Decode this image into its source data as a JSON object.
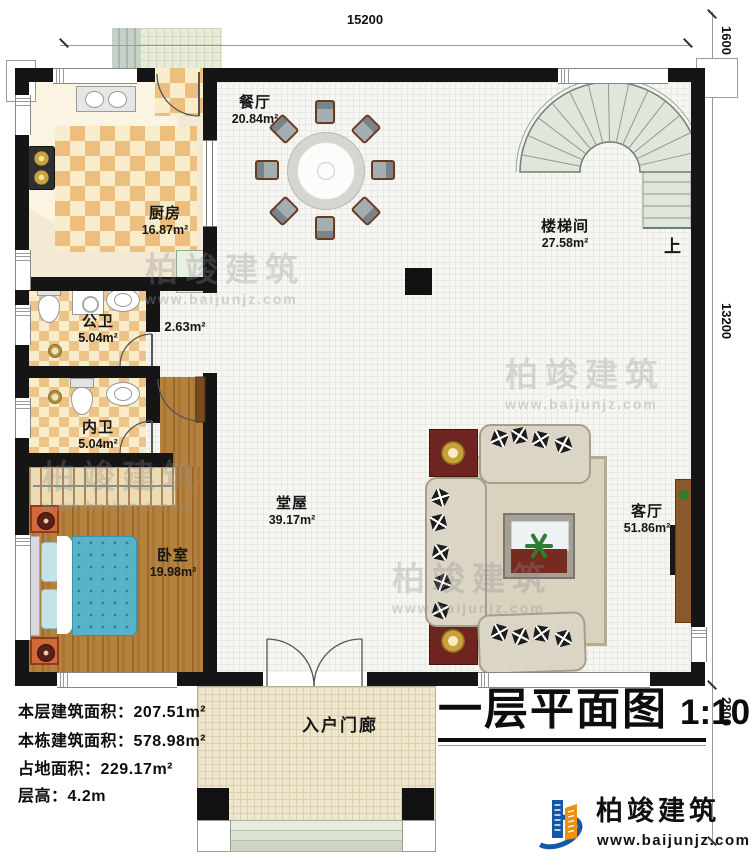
{
  "title_block": {
    "title": "一层平面图",
    "scale": "1:100"
  },
  "info": {
    "line1": "本层建筑面积：207.51m²",
    "line2": "本栋建筑面积：578.98m²",
    "line3": "占地面积：229.17m²",
    "line4": "层高：4.2m"
  },
  "rooms": {
    "dining": {
      "name": "餐厅",
      "area": "20.84m²"
    },
    "kitchen": {
      "name": "厨房",
      "area": "16.87m²"
    },
    "stairwell": {
      "name": "楼梯间",
      "area": "27.58m²"
    },
    "public_bath": {
      "name": "公卫",
      "area": "5.04m²"
    },
    "corridor": {
      "area": "2.63m²"
    },
    "private_bath": {
      "name": "内卫",
      "area": "5.04m²"
    },
    "bedroom": {
      "name": "卧室",
      "area": "19.98m²"
    },
    "hall": {
      "name": "堂屋",
      "area": "39.17m²"
    },
    "living": {
      "name": "客厅",
      "area": "51.86m²"
    },
    "porch": {
      "name": "入户门廊"
    }
  },
  "stairs": {
    "up_label": "上"
  },
  "dimensions": {
    "top": "15200",
    "right_top": "1600",
    "right_mid": "13200",
    "right_bottom": "2800"
  },
  "brand": {
    "name": "柏竣建筑",
    "url": "www.baijunjz.com"
  },
  "watermark": {
    "name": "柏竣建筑",
    "url": "www.baijunjz.com"
  },
  "colors": {
    "wall": "#151515",
    "accent_blue": "#1456a8",
    "accent_orange": "#f0900e"
  }
}
